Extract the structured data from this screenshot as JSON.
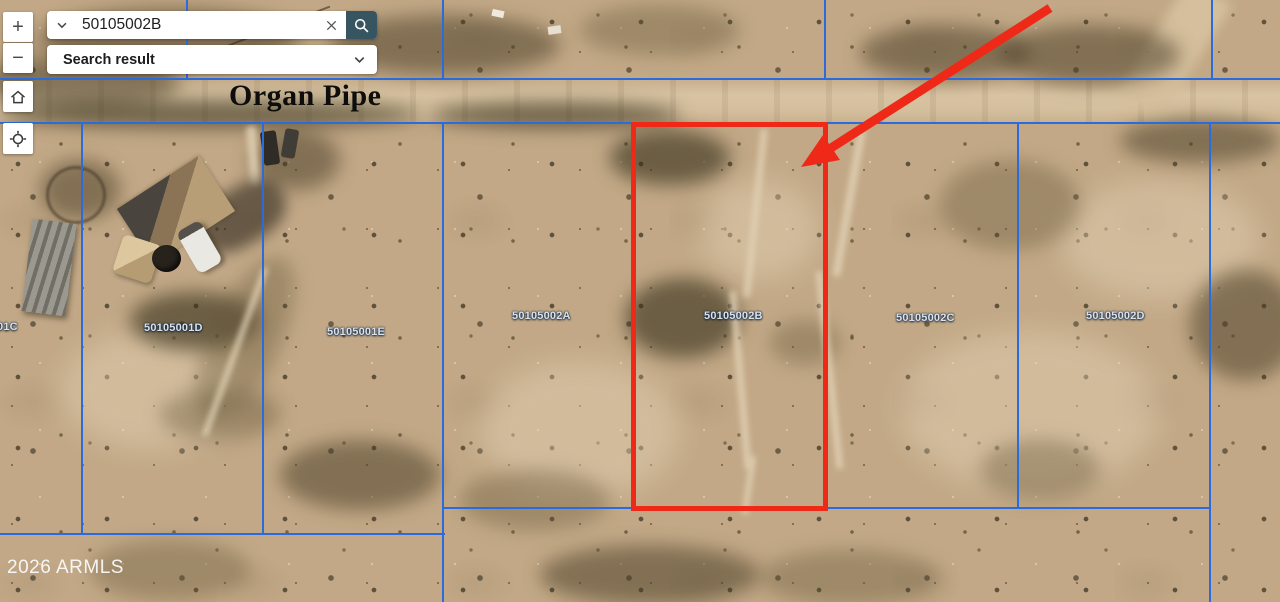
{
  "search_bar": {
    "value": "50105002B",
    "dropdown_label": "Search result"
  },
  "map_controls": {
    "zoom_in_label": "+",
    "zoom_out_label": "−"
  },
  "map": {
    "street_label": "Organ Pipe",
    "watermark": "2026 ARMLS",
    "parcel_labels": [
      "01C",
      "50105001D",
      "50105001E",
      "50105002A",
      "50105002B",
      "50105002C",
      "50105002D"
    ],
    "highlighted_parcel_id": "50105002B",
    "colors": {
      "parcel_line_blue": "#2b6bdb",
      "highlight_red": "#ef2917",
      "parcel_label_text": "#d7e3f0",
      "search_button_bg": "#375561"
    }
  }
}
